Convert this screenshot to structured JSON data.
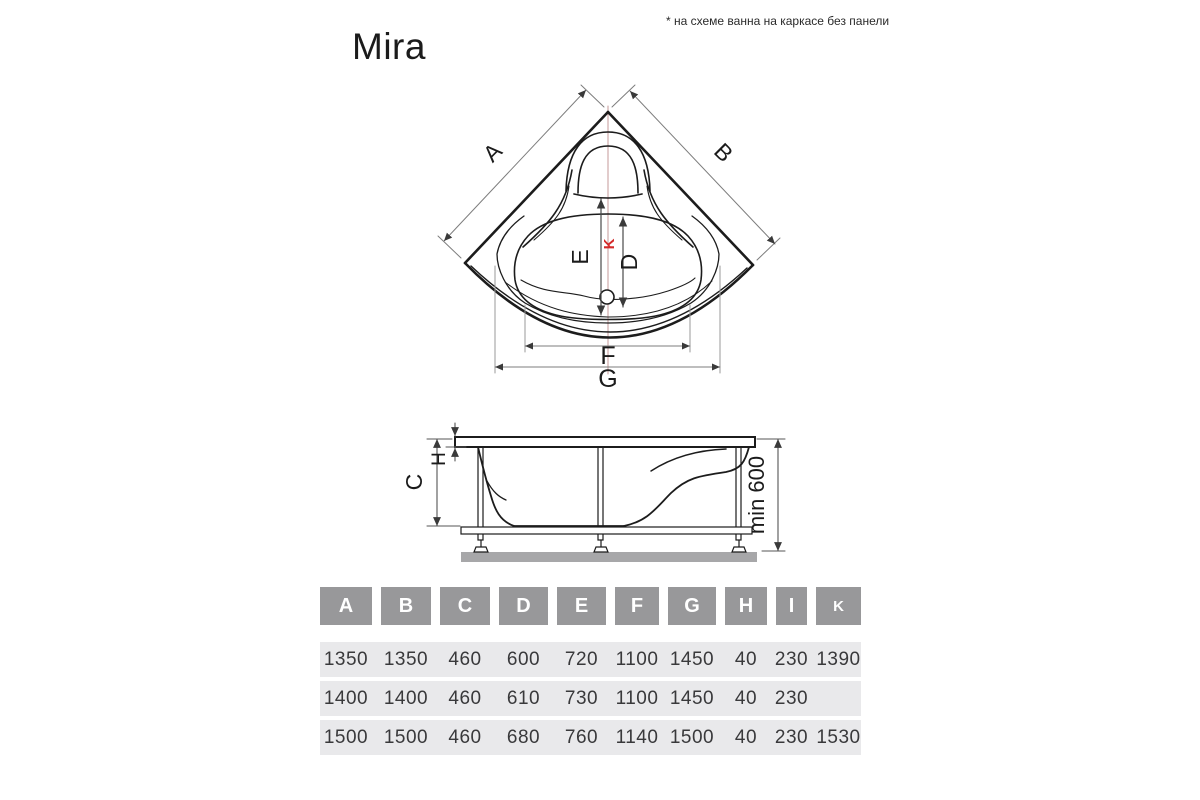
{
  "page": {
    "note": "* на схеме ванна на каркасе без панели",
    "title": "Mira"
  },
  "top_view": {
    "label_a": "A",
    "label_b": "B",
    "label_e": "E",
    "label_k": "K",
    "label_d": "D",
    "label_f": "F",
    "label_g": "G"
  },
  "side_view": {
    "label_c": "C",
    "label_h": "H",
    "label_min_height": "min 600"
  },
  "colors": {
    "line": "#1c1c1c",
    "dimension_line": "#7d7d7d",
    "accent_red": "#d42a2a",
    "centerline_red": "#c59a98",
    "table_header_bg": "#98989a",
    "table_row_bg": "#e9e9eb",
    "ground_gray": "#a7a7a9"
  },
  "table": {
    "headers": [
      "A",
      "B",
      "C",
      "D",
      "E",
      "F",
      "G",
      "H",
      "I",
      "K"
    ],
    "rows": [
      [
        "1350",
        "1350",
        "460",
        "600",
        "720",
        "1100",
        "1450",
        "40",
        "230",
        "1390"
      ],
      [
        "1400",
        "1400",
        "460",
        "610",
        "730",
        "1100",
        "1450",
        "40",
        "230",
        ""
      ],
      [
        "1500",
        "1500",
        "460",
        "680",
        "760",
        "1140",
        "1500",
        "40",
        "230",
        "1530"
      ]
    ]
  }
}
